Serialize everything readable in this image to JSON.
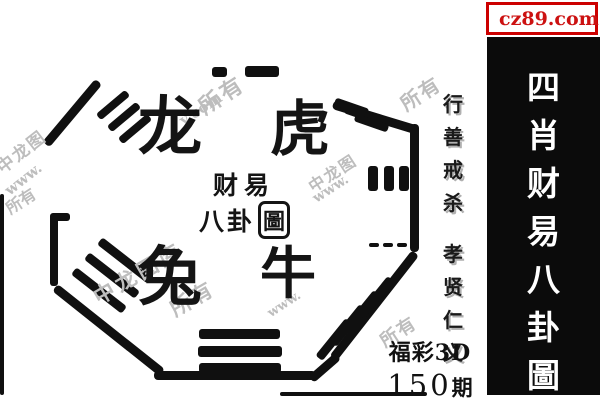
{
  "site_badge": {
    "label": "cz89.com",
    "icon": "yellow-square-icon",
    "border_color": "#cc0000",
    "text_color": "#cc1111",
    "icon_color": "#ffe400"
  },
  "right_banner": {
    "title": "四肖财易八卦圖",
    "chars": [
      "四",
      "肖",
      "财",
      "易",
      "八",
      "卦",
      "圖"
    ],
    "bg_color": "#0b0b0b",
    "text_color": "#ffffff"
  },
  "motto": {
    "full": "行善戒杀 孝贤仁义",
    "group1": [
      "行",
      "善",
      "戒",
      "杀"
    ],
    "group2": [
      "孝",
      "贤",
      "仁",
      "义"
    ]
  },
  "issue": {
    "game": "福彩3D",
    "number": "150",
    "suffix": "期"
  },
  "bagua_center": {
    "line1": "财易",
    "line2": "八卦",
    "seal": "圖"
  },
  "animals": [
    {
      "name": "dragon",
      "char": "龙"
    },
    {
      "name": "tiger",
      "char": "虎"
    },
    {
      "name": "rabbit",
      "char": "兔"
    },
    {
      "name": "ox",
      "char": "牛"
    }
  ],
  "watermarks": [
    "中龙图",
    "www.",
    "所有",
    "y.com",
    "中龙图",
    "www.",
    "所有",
    "中龙图库",
    "所有",
    "www.",
    "所有",
    "所有"
  ]
}
